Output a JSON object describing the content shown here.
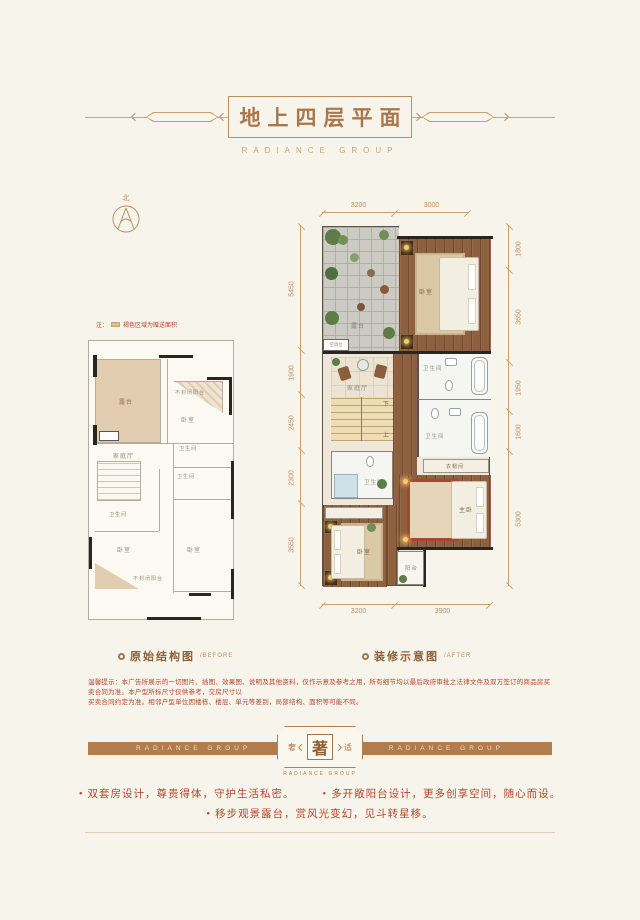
{
  "colors": {
    "bg": "#f7f4ec",
    "accent": "#b0824f",
    "dim": "#c9a070",
    "red": "#b5452c",
    "banner": "#b27c4c",
    "beige": "#e3cdb0",
    "wood": "#8f6040"
  },
  "header": {
    "title": "地上四层平面",
    "subtitle": "RADIANCE GROUP"
  },
  "compass": {
    "north_label": "北"
  },
  "plans": {
    "left": {
      "note_prefix": "注：",
      "note_text": "褐色区域为赠送面积",
      "caption": "原始结构图",
      "caption_en": "/BEFORE",
      "rooms": [
        "露台",
        "不封闭阳台",
        "卧室",
        "卫生间",
        "家庭厅",
        "卫生间",
        "卫生间",
        "卧室",
        "卧室",
        "不封闭阳台"
      ]
    },
    "right": {
      "caption": "装修示意图",
      "caption_en": "/AFTER",
      "dims_top": [
        "3200",
        "3000"
      ],
      "dims_bottom": [
        "3200",
        "3900"
      ],
      "dims_left": [
        "5450",
        "1900",
        "2450",
        "2300",
        "3550"
      ],
      "dims_right": [
        "1800",
        "3650",
        "1950",
        "1600",
        "5300"
      ],
      "rooms": [
        "露台",
        "卧室",
        "家庭厅",
        "卫生间",
        "卫生间",
        "衣帽间",
        "卫生间",
        "卧室",
        "主卧",
        "阳台"
      ],
      "stairs": {
        "up": "上",
        "down": "下"
      },
      "ac_label": "空调位"
    }
  },
  "banner": {
    "left_text": "RADIANCE GROUP",
    "right_text": "RADIANCE GROUP",
    "badge_left": "奢",
    "badge_center": "著",
    "badge_right": "适",
    "badge_sub": "RADIANCE GROUP"
  },
  "features": {
    "bullet": "•",
    "item1": "双套房设计，尊贵得体，守护生活私密。",
    "item2": "多开敞阳台设计，更多创享空间，随心而设。",
    "item3": "移步观景露台，赏风光变幻，见斗转星移。"
  },
  "disclaimer": {
    "line1": "温馨提示：本广告所展示的一切图片、插图、效果图、说明及其他资料，仅作示意及参考之用，所有细节均以最后政府审批之法律文件及双方签订的商品房买卖合同为准。本户型所标尺寸仅供参考，交房尺寸以",
    "line2": "买卖合同约定为准。相邻户型单位因楼栋、楼层、单元等差别，局部结构、面积等可能不同。"
  }
}
